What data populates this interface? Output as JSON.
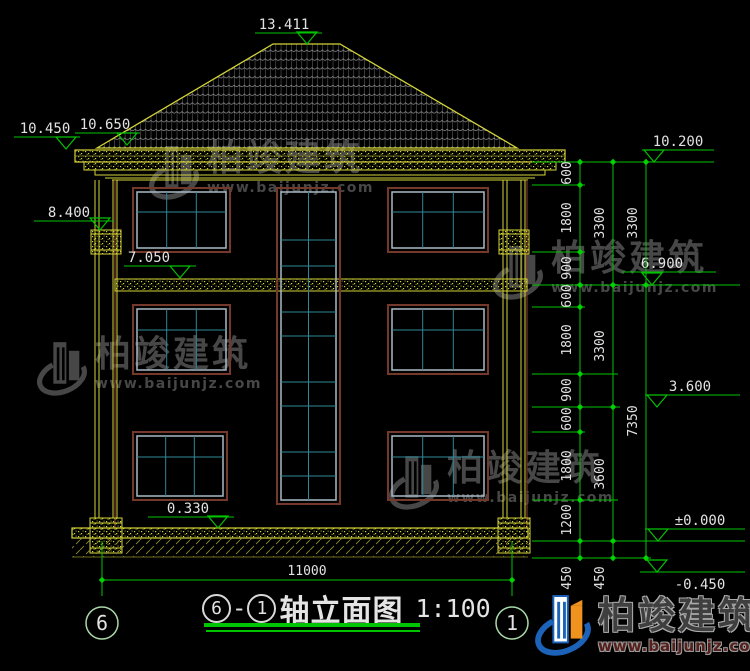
{
  "drawing_title": {
    "axis_start": "6",
    "separator": "-",
    "axis_end": "1",
    "name": "轴立面图",
    "scale": "1:100"
  },
  "axis_bubbles": {
    "left": "6",
    "right": "1"
  },
  "levels": {
    "ridge": "13.411",
    "eave_upper": "10.650",
    "eave": "10.450",
    "capital": "8.400",
    "band": "7.050",
    "plinth": "0.330",
    "right_top": "10.200",
    "right_floor3": "6.900",
    "right_floor2": "3.600",
    "right_zero": "±0.000",
    "right_foundation": "-0.450"
  },
  "dimensions": {
    "chain_inner": [
      "600",
      "1800",
      "900",
      "600",
      "1800",
      "900",
      "600",
      "1800",
      "1200",
      "450"
    ],
    "chain_middle": [
      "3300",
      "3300",
      "3600",
      "450"
    ],
    "chain_outer": [
      "3300",
      "7350"
    ],
    "overall_width": "11000"
  },
  "watermark": {
    "brand": "柏竣建筑",
    "website": "www.baijunjz.com"
  },
  "footer_logo": {
    "brand": "柏竣建筑",
    "website": "www.baijunjz.com"
  },
  "colors": {
    "background": "#000000",
    "cad_yellow": "#d4d438",
    "cad_green": "#00c400",
    "dim_text": "#e2e2e2",
    "window_frame": "#74392a",
    "window_frame_light": "#a9bac6",
    "window_mullion": "#2f8799",
    "roof_tile": "#9b9b9b",
    "watermark_gray": "#474747",
    "logo_blue": "#1b62b8",
    "logo_orange": "#f0921e"
  }
}
